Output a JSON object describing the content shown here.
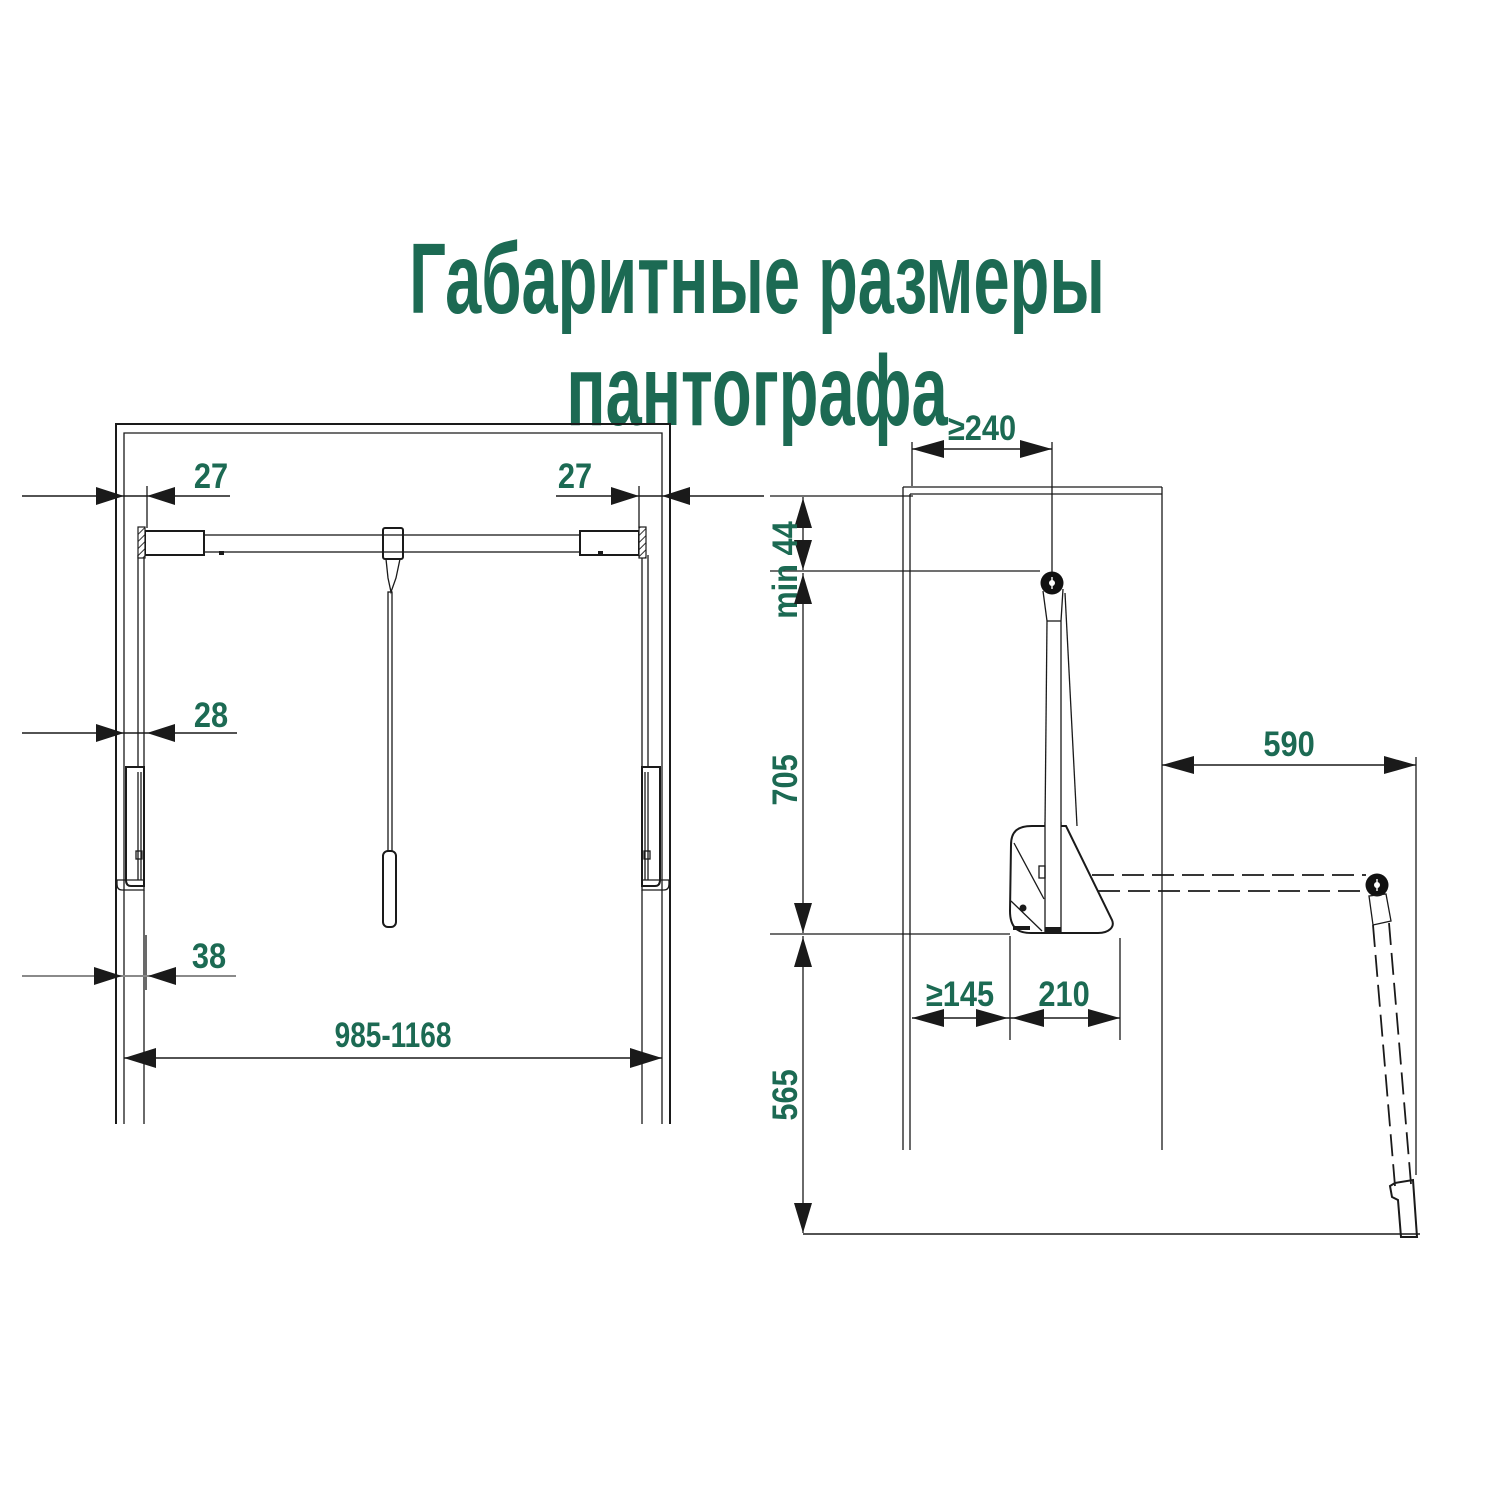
{
  "title": {
    "line1": "Габаритные размеры",
    "line2": "пантографа"
  },
  "colors": {
    "accent_green": "#1c6a53",
    "drawing_line": "#1a1a1a",
    "grey_dim_line": "#8a8a8a",
    "background": "#ffffff"
  },
  "front_view": {
    "dimensions": {
      "offset_top_left": "27",
      "offset_top_right": "27",
      "offset_middle_left": "28",
      "offset_bottom_left": "38",
      "width_range": "985-1168"
    }
  },
  "side_view": {
    "dimensions": {
      "min_depth_to_axis": "≥240",
      "min_top_clearance": "min 44",
      "upper_height": "705",
      "reach": "590",
      "min_back_clearance": "≥145",
      "body_width": "210",
      "lower_height": "565"
    }
  }
}
